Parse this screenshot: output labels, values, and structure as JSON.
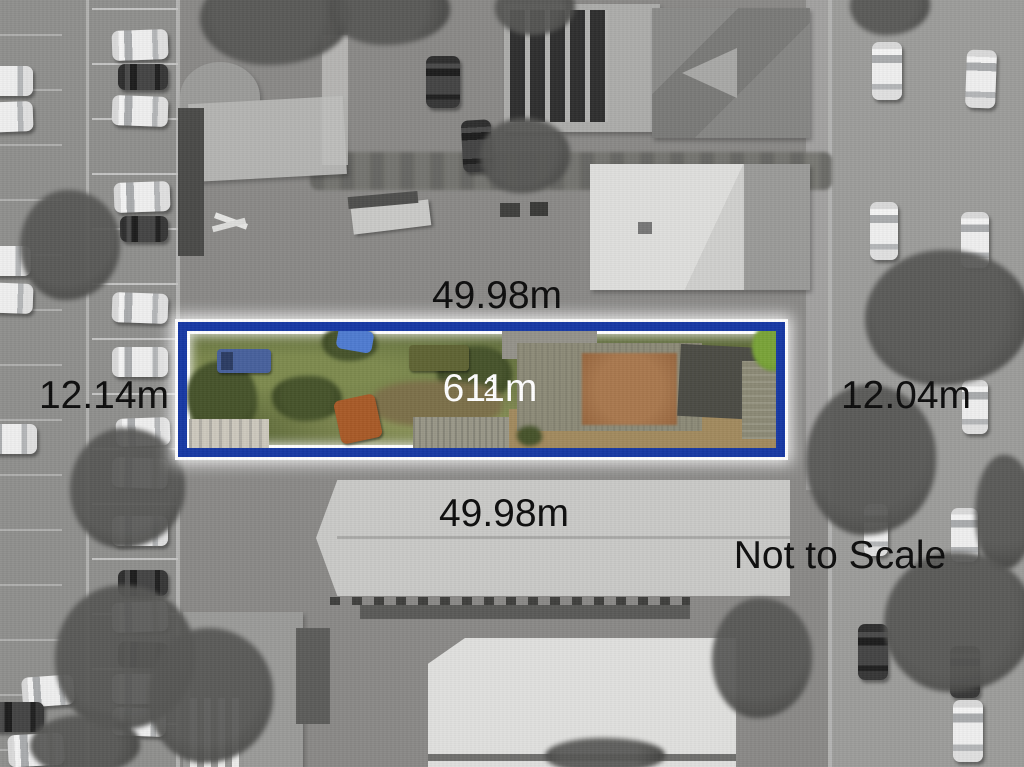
{
  "labels": {
    "top_width": "49.98m",
    "bottom_width": "49.98m",
    "left_width": "12.14m",
    "right_width": "12.04m",
    "area": "611m",
    "area_sup": "2",
    "scale_note": "Not to Scale"
  },
  "colors": {
    "boundary_blue": "#1638a4",
    "boundary_glow": "#ffffff",
    "dimension_text": "#0c0c0c",
    "area_text": "#ffffff"
  },
  "scene": {
    "cars": [
      {
        "x": 112,
        "y": 30,
        "w": 56,
        "h": 30,
        "c": "w",
        "r": -2
      },
      {
        "x": 118,
        "y": 64,
        "w": 50,
        "h": 26,
        "c": "d",
        "r": 0
      },
      {
        "x": 112,
        "y": 96,
        "w": 56,
        "h": 30,
        "c": "w",
        "r": 2
      },
      {
        "x": 114,
        "y": 182,
        "w": 56,
        "h": 30,
        "c": "w",
        "r": -2
      },
      {
        "x": 120,
        "y": 216,
        "w": 48,
        "h": 26,
        "c": "d",
        "r": 0
      },
      {
        "x": 112,
        "y": 293,
        "w": 56,
        "h": 30,
        "c": "w",
        "r": 2
      },
      {
        "x": 112,
        "y": 347,
        "w": 56,
        "h": 30,
        "c": "w",
        "r": 0
      },
      {
        "x": 116,
        "y": 418,
        "w": 54,
        "h": 28,
        "c": "w",
        "r": -2
      },
      {
        "x": 112,
        "y": 458,
        "w": 56,
        "h": 30,
        "c": "w",
        "r": 2
      },
      {
        "x": 112,
        "y": 516,
        "w": 56,
        "h": 30,
        "c": "w",
        "r": 0
      },
      {
        "x": 118,
        "y": 570,
        "w": 50,
        "h": 26,
        "c": "d",
        "r": 0
      },
      {
        "x": 112,
        "y": 602,
        "w": 56,
        "h": 30,
        "c": "w",
        "r": -2
      },
      {
        "x": 118,
        "y": 642,
        "w": 50,
        "h": 26,
        "c": "d",
        "r": 2
      },
      {
        "x": 112,
        "y": 674,
        "w": 56,
        "h": 30,
        "c": "w",
        "r": 0
      },
      {
        "x": 112,
        "y": 708,
        "w": 54,
        "h": 28,
        "c": "w",
        "r": 2
      },
      {
        "x": -22,
        "y": 66,
        "w": 55,
        "h": 30,
        "c": "w",
        "r": 0
      },
      {
        "x": -22,
        "y": 102,
        "w": 55,
        "h": 30,
        "c": "w",
        "r": -2
      },
      {
        "x": -24,
        "y": 246,
        "w": 55,
        "h": 30,
        "c": "w",
        "r": 0
      },
      {
        "x": -22,
        "y": 283,
        "w": 55,
        "h": 30,
        "c": "w",
        "r": 2
      },
      {
        "x": -18,
        "y": 424,
        "w": 55,
        "h": 30,
        "c": "w",
        "r": 0
      },
      {
        "x": 22,
        "y": 676,
        "w": 52,
        "h": 30,
        "c": "w",
        "r": -4
      },
      {
        "x": -8,
        "y": 702,
        "w": 52,
        "h": 30,
        "c": "d",
        "r": 0
      },
      {
        "x": 8,
        "y": 734,
        "w": 56,
        "h": 32,
        "c": "w",
        "r": -3
      },
      {
        "x": 426,
        "y": 56,
        "w": 34,
        "h": 52,
        "c": "d",
        "r": 0
      },
      {
        "x": 462,
        "y": 120,
        "w": 30,
        "h": 52,
        "c": "d",
        "r": -3
      },
      {
        "x": 872,
        "y": 42,
        "w": 30,
        "h": 58,
        "c": "w",
        "r": 0
      },
      {
        "x": 966,
        "y": 50,
        "w": 30,
        "h": 58,
        "c": "w",
        "r": 2
      },
      {
        "x": 870,
        "y": 202,
        "w": 28,
        "h": 58,
        "c": "w",
        "r": 0
      },
      {
        "x": 961,
        "y": 212,
        "w": 28,
        "h": 56,
        "c": "w",
        "r": 0
      },
      {
        "x": 962,
        "y": 380,
        "w": 26,
        "h": 54,
        "c": "w",
        "r": 0
      },
      {
        "x": 864,
        "y": 504,
        "w": 24,
        "h": 52,
        "c": "w",
        "r": 0
      },
      {
        "x": 951,
        "y": 508,
        "w": 27,
        "h": 54,
        "c": "w",
        "r": 0
      },
      {
        "x": 858,
        "y": 624,
        "w": 30,
        "h": 56,
        "c": "d",
        "r": 0
      },
      {
        "x": 950,
        "y": 646,
        "w": 30,
        "h": 52,
        "c": "d",
        "r": 0
      },
      {
        "x": 953,
        "y": 700,
        "w": 30,
        "h": 62,
        "c": "w",
        "r": 0
      }
    ],
    "trees": [
      {
        "x": 200,
        "y": -30,
        "w": 150,
        "h": 95
      },
      {
        "x": 330,
        "y": -25,
        "w": 120,
        "h": 70
      },
      {
        "x": 495,
        "y": -20,
        "w": 80,
        "h": 55
      },
      {
        "x": 850,
        "y": -25,
        "w": 80,
        "h": 60
      },
      {
        "x": 20,
        "y": 190,
        "w": 100,
        "h": 110
      },
      {
        "x": 70,
        "y": 428,
        "w": 115,
        "h": 120
      },
      {
        "x": 55,
        "y": 585,
        "w": 140,
        "h": 145
      },
      {
        "x": 148,
        "y": 628,
        "w": 125,
        "h": 135
      },
      {
        "x": 480,
        "y": 118,
        "w": 90,
        "h": 75
      },
      {
        "x": 865,
        "y": 250,
        "w": 165,
        "h": 135
      },
      {
        "x": 806,
        "y": 385,
        "w": 130,
        "h": 150
      },
      {
        "x": 975,
        "y": 455,
        "w": 60,
        "h": 115
      },
      {
        "x": 884,
        "y": 552,
        "w": 150,
        "h": 140
      },
      {
        "x": 712,
        "y": 598,
        "w": 100,
        "h": 120
      },
      {
        "x": 30,
        "y": 715,
        "w": 110,
        "h": 60
      },
      {
        "x": 545,
        "y": 738,
        "w": 120,
        "h": 35
      }
    ]
  }
}
